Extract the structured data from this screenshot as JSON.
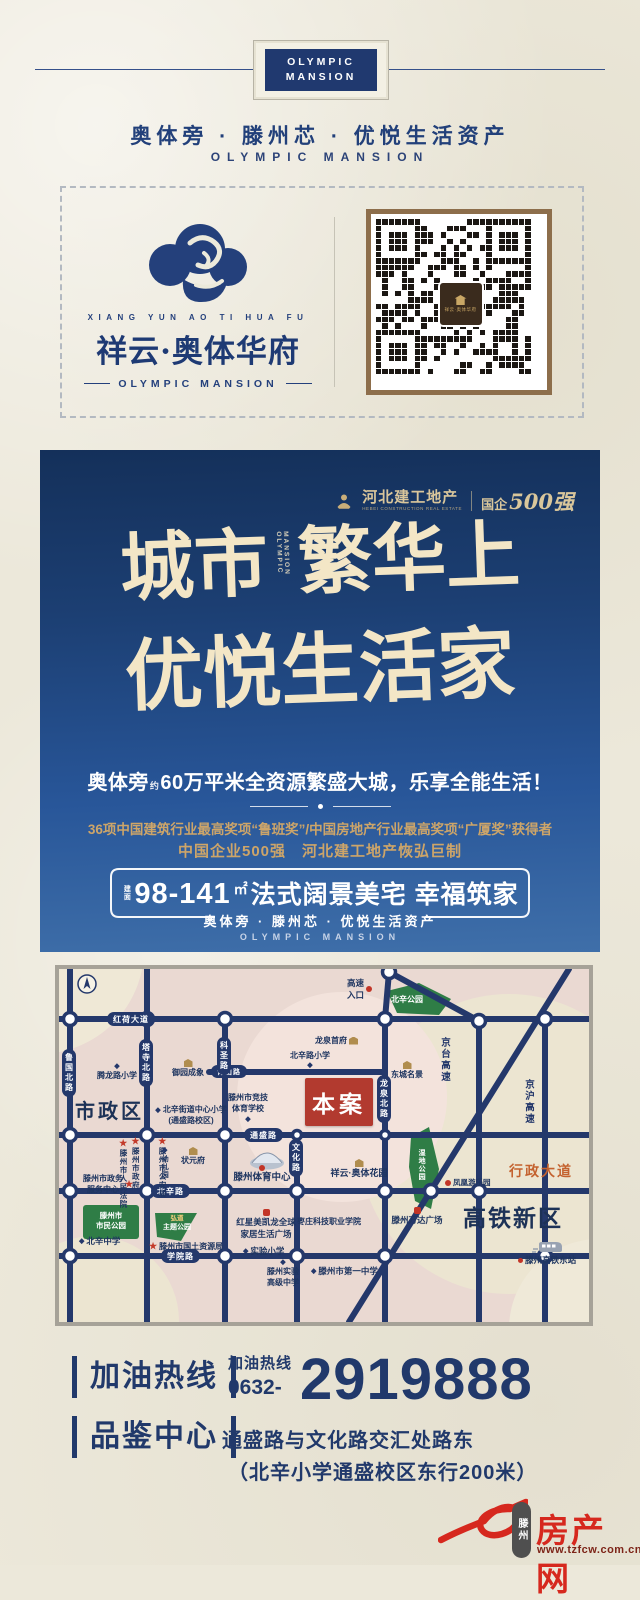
{
  "header": {
    "badge1": "OLYMPIC",
    "badge2": "MANSION",
    "tagline_cn": "奥体旁 · 滕州芯 · 优悦生活资产",
    "tagline_en": "OLYMPIC MANSION"
  },
  "brand": {
    "en_small": "XIANG YUN AO TI HUA FU",
    "name": "祥云·奥体华府",
    "en": "OLYMPIC MANSION",
    "qr_logo": "祥云·奥体华府"
  },
  "banner": {
    "dev_name": "河北建工地产",
    "dev_sub": "HEBEI CONSTRUCTION REAL ESTATE",
    "dev_tag_small": "国企",
    "dev_tag_big": "500强",
    "h1a": "城市",
    "h1v": "MANSION OLYMPIC",
    "h1b": "繁华上",
    "h2": "优悦生活家",
    "sub1": "奥体旁",
    "sub_approx": "约",
    "sub2": "60万平米全资源繁盛大城，乐享全能生活！",
    "award1": "36项中国建筑行业最高奖项“鲁班奖”/中国房地产行业最高奖项“广厦奖”获得者",
    "award2": "中国企业500强　河北建工地产恢弘巨制",
    "area_label": "建面",
    "range": "98-141",
    "unit": "㎡",
    "slogan": "法式阔景美宅 幸福筑家",
    "sub_cn": "奥体旁 · 滕州芯 · 优悦生活资产",
    "sub_en": "OLYMPIC MANSION"
  },
  "map": {
    "site": "本案",
    "zone1": "市政区",
    "zone2": "高铁新区",
    "roads": {
      "honghe": "红荷大道",
      "tongsheng": "通盛路",
      "beixin": "北辛路",
      "xueyuan": "学院路",
      "qingshan": "青山路",
      "luguo": "鲁国北路",
      "tasi": "塔寺北路",
      "kesheng": "科圣路",
      "wenhua": "文化路",
      "longquan": "龙泉北路",
      "jingtai": "京台高速",
      "jinghu": "京沪高速",
      "xingzheng": "行政大道"
    },
    "parks": {
      "beixin_park": "北辛公园",
      "shimin1": "滕州市",
      "shimin2": "市民公园",
      "theme1": "弘道",
      "theme2": "主题公园",
      "wetland": "湿地公园"
    },
    "pois": {
      "court": "滕州市人民法院",
      "gov": "滕州市政府",
      "police": "滕州市公安局",
      "service1": "滕州市政务",
      "service2": "服务中心",
      "tenglong": "腾龙路小学",
      "yuyuan": "御园成象",
      "beixin_central1": "北辛街道中心小学",
      "beixin_central2": "(通盛路校区)",
      "kindergarten": "幼儿园",
      "zhuangyuanfu": "状元府",
      "sports_school1": "滕州市竞技",
      "sports_school2": "体育学校",
      "beixinlu_primary": "北辛路小学",
      "highway1": "高速",
      "highway2": "入口",
      "longquan_mansion": "龙泉首府",
      "dongcheng": "东城名景",
      "sports_center": "滕州体育中心",
      "aoti_garden": "祥云·奥体花园",
      "beixin_middle": "北辛中学",
      "land_bureau": "滕州市国土资源局",
      "hongxing1": "红星美凯龙全球",
      "hongxing2": "家居生活广场",
      "shiyan_primary": "实验小学",
      "zaozhuang_college": "枣庄科技职业学院",
      "shiyan_high1": "滕州实验",
      "shiyan_high2": "高级中学",
      "first_middle": "滕州市第一中学",
      "wanda": "滕州万达广场",
      "fenghuang": "凤凰游乐园",
      "east_station": "滕州高铁东站"
    }
  },
  "contact": {
    "hotline_label": "加油热线",
    "hotline_small": "加油热线",
    "phone_prefix": "0632-",
    "phone": "2919888",
    "center_label": "品鉴中心",
    "addr1": "通盛路与文化路交汇处路东",
    "addr2": "（北辛小学通盛校区东行200米）"
  },
  "footer": {
    "city": "滕州",
    "site": "房产网",
    "url": "www.tzfcw.com.cn"
  }
}
